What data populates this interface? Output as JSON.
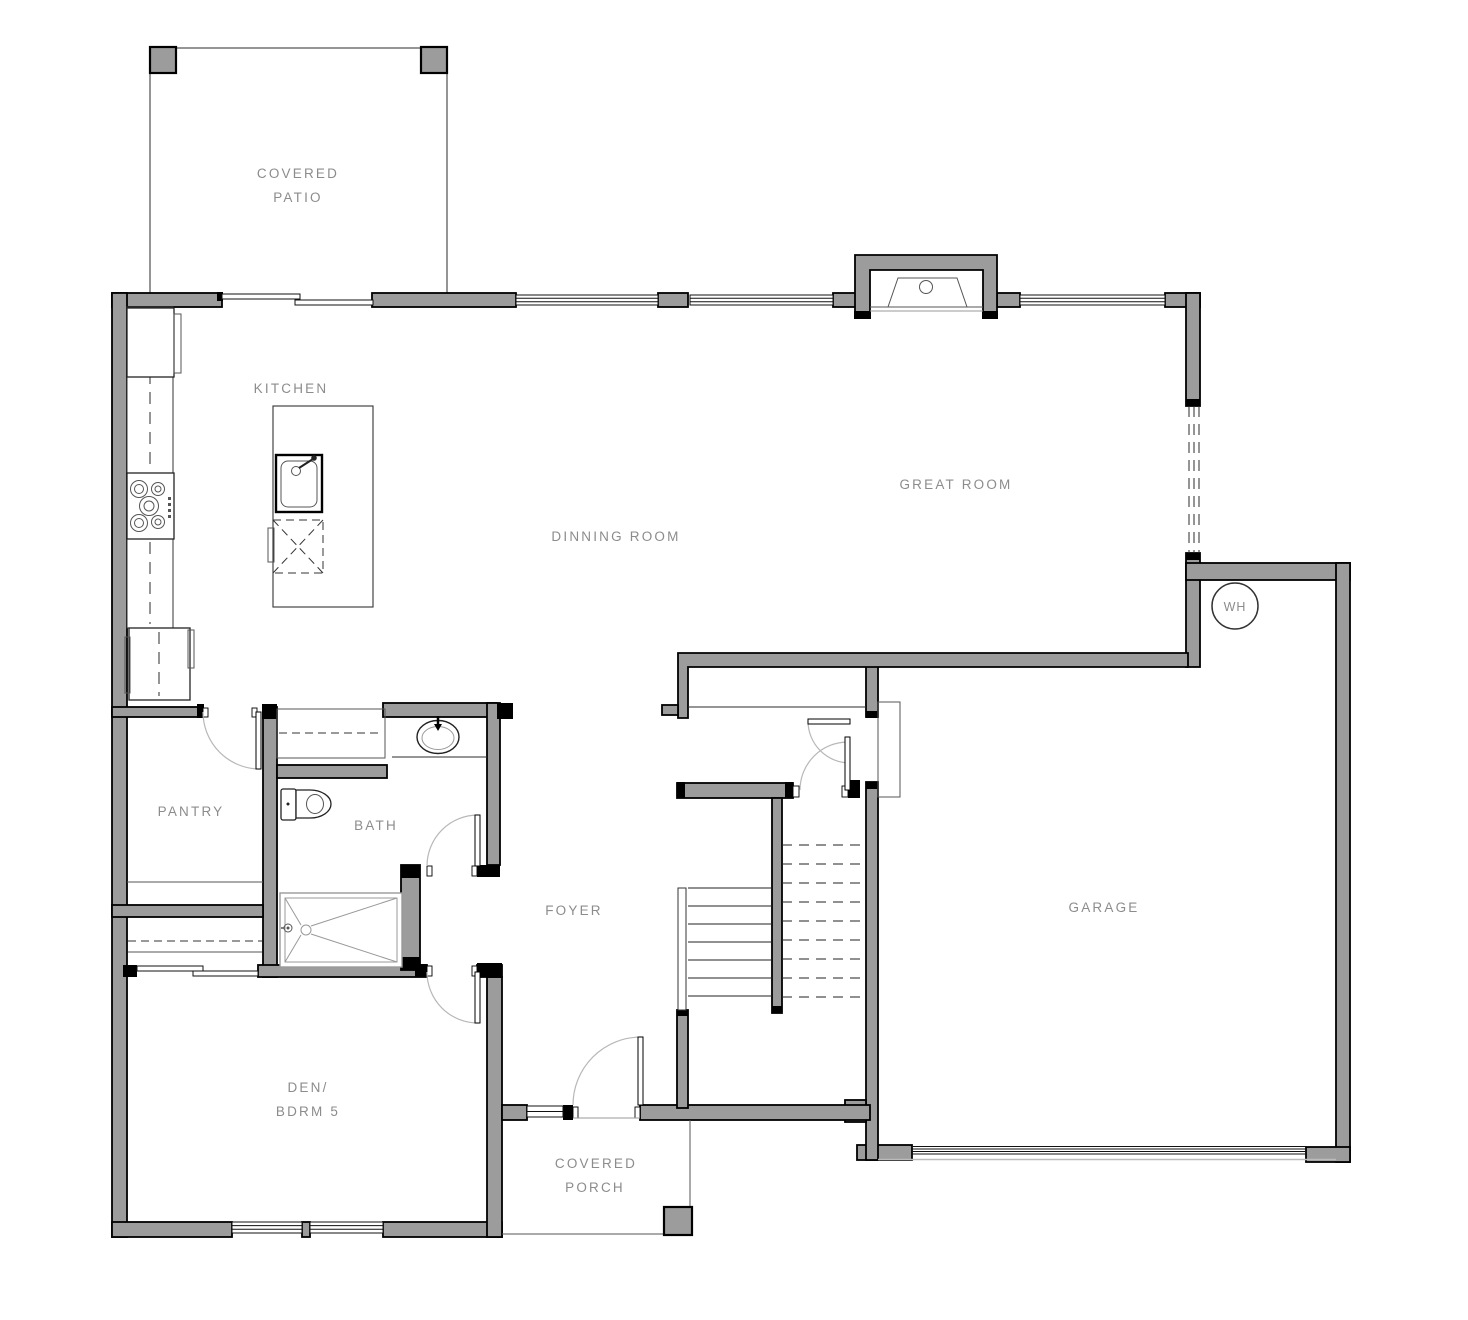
{
  "title": "First Floor Plan",
  "colors": {
    "bg": "#ffffff",
    "wall_fill": "#9c9c9c",
    "wall_stroke": "#000000",
    "label_color": "#8c8c8c",
    "thin_line": "#2b2b2b",
    "door_arc": "#b8b8b8"
  },
  "rooms": {
    "covered_patio": {
      "line1": "COVERED",
      "line2": "PATIO"
    },
    "kitchen": {
      "label": "KITCHEN"
    },
    "dinning_room": {
      "label": "DINNING ROOM"
    },
    "great_room": {
      "label": "GREAT ROOM"
    },
    "pantry": {
      "label": "PANTRY"
    },
    "bath": {
      "label": "BATH"
    },
    "foyer": {
      "label": "FOYER"
    },
    "garage": {
      "label": "GARAGE"
    },
    "den_bdrm5": {
      "line1": "DEN/",
      "line2": "BDRM 5"
    },
    "covered_porch": {
      "line1": "COVERED",
      "line2": "PORCH"
    },
    "water_heater": {
      "label": "WH"
    }
  }
}
